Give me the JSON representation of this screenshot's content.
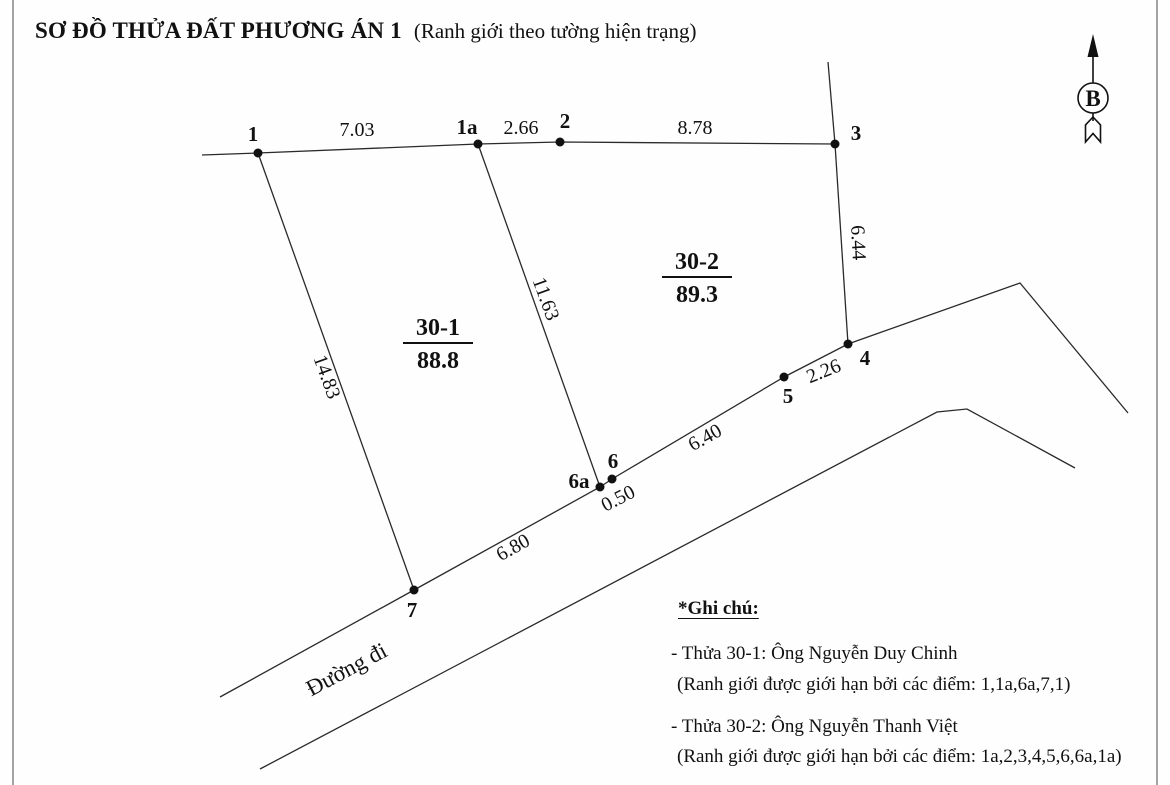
{
  "title": "SƠ ĐỒ THỬA ĐẤT PHƯƠNG ÁN 1",
  "subtitle": "(Ranh giới theo tường hiện trạng)",
  "north_label": "B",
  "road_label": "Đường đi",
  "points": [
    {
      "label": "1"
    },
    {
      "label": "1a"
    },
    {
      "label": "2"
    },
    {
      "label": "3"
    },
    {
      "label": "4"
    },
    {
      "label": "5"
    },
    {
      "label": "6"
    },
    {
      "label": "6a"
    },
    {
      "label": "7"
    }
  ],
  "measurements": [
    {
      "from": "1",
      "to": "1a",
      "value": "7.03"
    },
    {
      "from": "1a",
      "to": "2",
      "value": "2.66"
    },
    {
      "from": "2",
      "to": "3",
      "value": "8.78"
    },
    {
      "from": "3",
      "to": "4",
      "value": "6.44"
    },
    {
      "from": "5",
      "to": "4",
      "value": "2.26"
    },
    {
      "from": "6",
      "to": "5",
      "value": "6.40"
    },
    {
      "from": "6a",
      "to": "6",
      "value": "0.50"
    },
    {
      "from": "1a",
      "to": "6a",
      "value": "11.63"
    },
    {
      "from": "1",
      "to": "7",
      "value": "14.83"
    },
    {
      "from": "7",
      "to": "6a",
      "value": "6.80"
    }
  ],
  "parcels": [
    {
      "id": "30-1",
      "area": "88.8",
      "owner": "Ông Nguyễn Duy Chinh",
      "boundary_points": "1,1a,6a,7,1"
    },
    {
      "id": "30-2",
      "area": "89.3",
      "owner": "Ông Nguyễn Thanh Việt",
      "boundary_points": "1a,2,3,4,5,6,6a,1a"
    }
  ],
  "notes": {
    "heading": "*Ghi chú:",
    "items": [
      {
        "line1": "- Thửa 30-1: Ông Nguyễn Duy Chinh",
        "line2": "(Ranh giới được giới hạn bởi các điểm: 1,1a,6a,7,1)"
      },
      {
        "line1": "- Thửa 30-2: Ông Nguyễn Thanh Việt",
        "line2": "(Ranh giới được giới hạn bởi các điểm: 1a,2,3,4,5,6,6a,1a)"
      }
    ]
  }
}
